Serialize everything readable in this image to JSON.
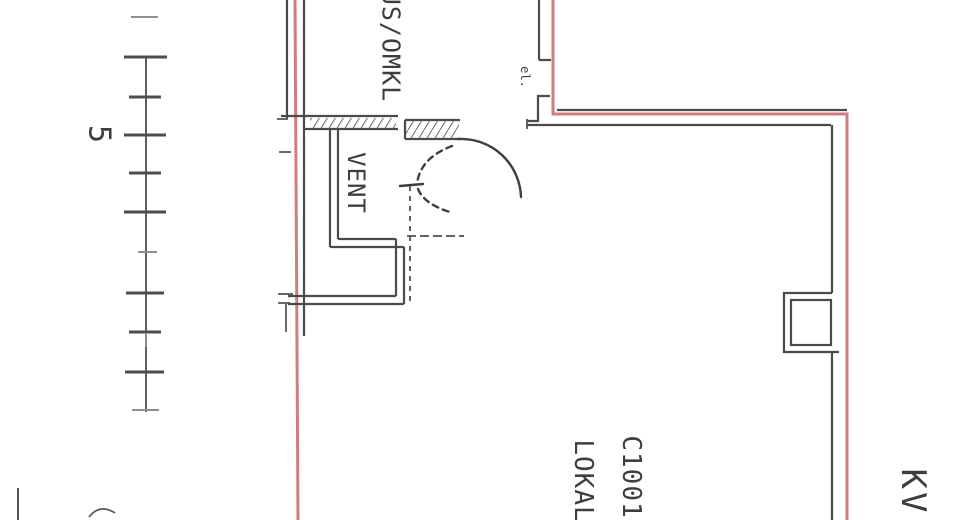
{
  "document": {
    "kind": "scanned architectural floor plan, drawing rotated 90 degrees clockwise",
    "labels": {
      "room_top": "US/OMKL",
      "vent": "VENT",
      "el": "el.",
      "main_room_id": "C1001",
      "main_room_name": "LOKAL",
      "block": "KV",
      "scale_value": "5"
    },
    "colors": {
      "ink": "#4a4a4a",
      "highlight_red": "#cb6a6e",
      "paper": "#ffffff"
    }
  }
}
